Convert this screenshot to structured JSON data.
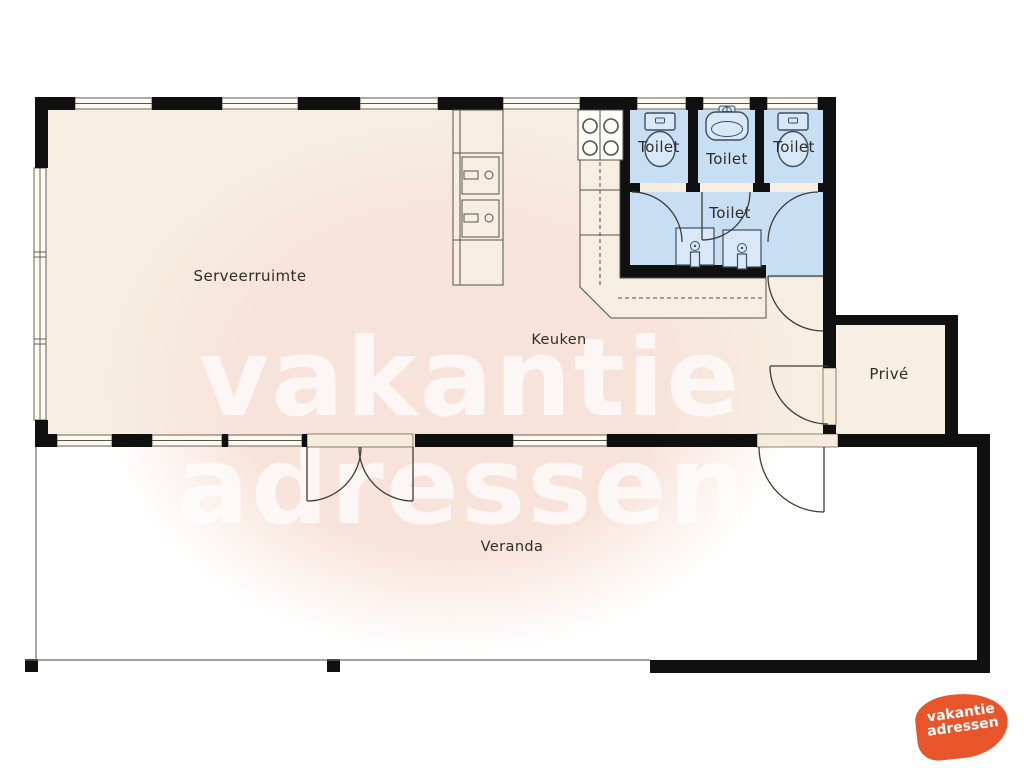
{
  "title": "Vakantiewoning plattegrond",
  "rooms": {
    "serveerruimte": "Serveerruimte",
    "keuken": "Keuken",
    "toilet1": "Toilet",
    "toilet2": "Toilet",
    "toilet3": "Toilet",
    "toilet4": "Toilet",
    "prive": "Privé",
    "veranda": "Veranda"
  },
  "watermark": {
    "line1": "vakantie",
    "line2": "adressen"
  },
  "logo": {
    "line1": "vakantie",
    "line2": "adressen"
  },
  "colors": {
    "wall": "#101010",
    "floor_cream": "#f6eee0",
    "floor_blue": "#c8def2",
    "floor_white": "#ffffff",
    "fixture_fill": "#d8e8f8",
    "fixture_outline": "#3f4e60",
    "thin_line": "#55524a",
    "watermark_blob": "#f8e3da",
    "watermark_text": "#ffffff",
    "logo_orange": "#e8552a"
  }
}
